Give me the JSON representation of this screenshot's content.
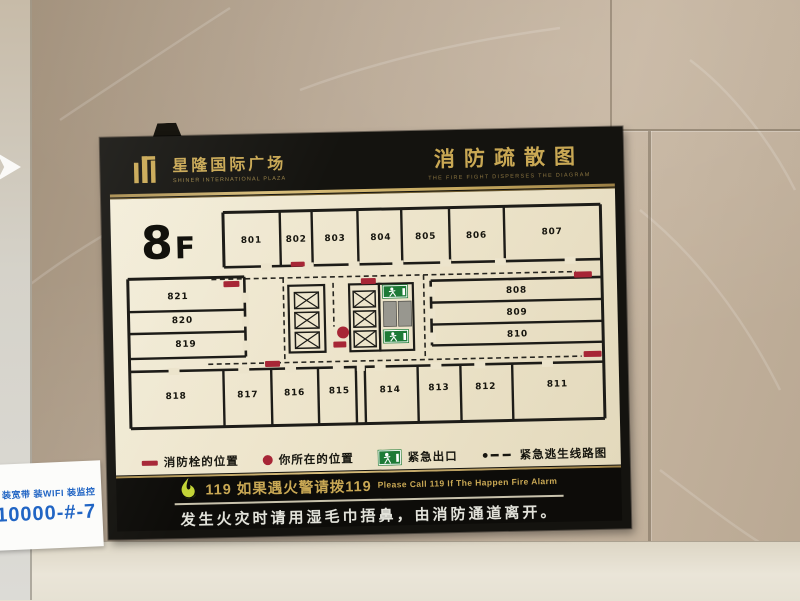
{
  "colors": {
    "gold": "#c9a854",
    "red": "#a72636",
    "green": "#1d7a36",
    "cream": "#ece4cc",
    "blue": "#2165c4",
    "elevator_gray": "#98978f",
    "wall_line": "#1d1c18"
  },
  "sticker": {
    "line1": "装宽带 装WIFI 装监控",
    "line2": "10000-#-7"
  },
  "sign": {
    "header": {
      "brand_cn": "星隆国际广场",
      "brand_en": "SHINER INTERNATIONAL PLAZA",
      "title_cn": "消防疏散图",
      "title_en": "THE FIRE FIGHT DISPERSES THE DIAGRAM"
    },
    "floor_label": {
      "big": "8",
      "small": "F"
    },
    "plan": {
      "view": [
        0,
        0,
        507,
        252
      ],
      "rooms": [
        {
          "id": "801",
          "lx": 141,
          "ly": 46
        },
        {
          "id": "802",
          "lx": 186,
          "ly": 46
        },
        {
          "id": "803",
          "lx": 225,
          "ly": 46
        },
        {
          "id": "804",
          "lx": 271,
          "ly": 46
        },
        {
          "id": "805",
          "lx": 316,
          "ly": 46
        },
        {
          "id": "806",
          "lx": 367,
          "ly": 46
        },
        {
          "id": "807",
          "lx": 443,
          "ly": 44
        },
        {
          "id": "808",
          "lx": 406,
          "ly": 102
        },
        {
          "id": "809",
          "lx": 406,
          "ly": 124
        },
        {
          "id": "810",
          "lx": 406,
          "ly": 146
        },
        {
          "id": "811",
          "lx": 445,
          "ly": 197
        },
        {
          "id": "812",
          "lx": 373,
          "ly": 198
        },
        {
          "id": "813",
          "lx": 326,
          "ly": 198
        },
        {
          "id": "814",
          "lx": 277,
          "ly": 199
        },
        {
          "id": "815",
          "lx": 226,
          "ly": 199
        },
        {
          "id": "816",
          "lx": 181,
          "ly": 200
        },
        {
          "id": "817",
          "lx": 134,
          "ly": 201
        },
        {
          "id": "818",
          "lx": 62,
          "ly": 201
        },
        {
          "id": "819",
          "lx": 73,
          "ly": 149
        },
        {
          "id": "820",
          "lx": 70,
          "ly": 125
        },
        {
          "id": "821",
          "lx": 66,
          "ly": 101
        }
      ],
      "walls": [
        [
          113,
          15,
          492,
          15,
          3
        ],
        [
          492,
          15,
          492,
          230,
          3
        ],
        [
          16,
          230,
          492,
          230,
          3
        ],
        [
          16,
          80,
          16,
          230,
          3
        ],
        [
          16,
          80,
          133,
          80,
          3
        ],
        [
          113,
          15,
          113,
          70,
          3
        ],
        [
          113,
          70,
          492,
          70,
          2.6
        ],
        [
          170,
          15,
          170,
          70,
          2.4
        ],
        [
          202,
          15,
          202,
          70,
          2.4
        ],
        [
          248,
          15,
          248,
          70,
          2.4
        ],
        [
          292,
          15,
          292,
          70,
          2.4
        ],
        [
          340,
          15,
          340,
          70,
          2.4
        ],
        [
          395,
          15,
          395,
          70,
          2.4
        ],
        [
          133,
          80,
          133,
          160,
          2.6
        ],
        [
          16,
          113,
          133,
          113,
          2.4
        ],
        [
          16,
          135,
          133,
          135,
          2.4
        ],
        [
          16,
          160,
          133,
          160,
          2.4
        ],
        [
          320,
          88,
          320,
          153,
          2.6
        ],
        [
          320,
          88,
          492,
          88,
          2.6
        ],
        [
          320,
          110,
          492,
          110,
          2.4
        ],
        [
          320,
          132,
          492,
          132,
          2.4
        ],
        [
          320,
          153,
          492,
          153,
          2.4
        ],
        [
          16,
          173,
          492,
          173,
          2.6
        ],
        [
          110,
          173,
          110,
          230,
          2.4
        ],
        [
          158,
          173,
          158,
          230,
          2.4
        ],
        [
          205,
          173,
          205,
          230,
          2.4
        ],
        [
          243,
          173,
          243,
          230,
          2.4
        ],
        [
          252,
          173,
          252,
          230,
          2.4
        ],
        [
          305,
          173,
          305,
          230,
          2.4
        ],
        [
          348,
          173,
          348,
          230,
          2.4
        ],
        [
          400,
          173,
          400,
          230,
          2.4
        ]
      ],
      "door_gaps": [
        [
          150,
          67,
          11,
          7
        ],
        [
          192,
          67,
          11,
          7
        ],
        [
          238,
          67,
          11,
          7
        ],
        [
          282,
          67,
          11,
          7
        ],
        [
          330,
          67,
          11,
          7
        ],
        [
          385,
          67,
          11,
          7
        ],
        [
          455,
          67,
          11,
          7
        ],
        [
          55,
          170,
          11,
          7
        ],
        [
          125,
          170,
          11,
          7
        ],
        [
          172,
          170,
          11,
          7
        ],
        [
          220,
          170,
          11,
          7
        ],
        [
          262,
          170,
          11,
          7
        ],
        [
          318,
          170,
          11,
          7
        ],
        [
          362,
          170,
          11,
          7
        ],
        [
          430,
          170,
          11,
          7
        ],
        [
          244,
          170,
          8,
          7
        ],
        [
          130,
          96,
          7,
          10
        ],
        [
          130,
          120,
          7,
          10
        ],
        [
          130,
          144,
          7,
          10
        ],
        [
          317,
          94,
          7,
          10
        ],
        [
          317,
          116,
          7,
          10
        ],
        [
          317,
          140,
          7,
          10
        ]
      ],
      "shafts": [
        {
          "x": 177,
          "y": 90,
          "w": 36,
          "h": 67,
          "cells": [
            [
              183,
              97,
              24,
              16
            ],
            [
              183,
              117,
              24,
              16
            ],
            [
              183,
              137,
              24,
              16
            ]
          ]
        },
        {
          "x": 238,
          "y": 90,
          "w": 30,
          "h": 67,
          "cells": [
            [
              242,
              97,
              22,
              16
            ],
            [
              242,
              117,
              22,
              16
            ],
            [
              242,
              137,
              22,
              16
            ]
          ]
        }
      ],
      "elevator_bay": {
        "x": 268,
        "y": 90,
        "w": 34,
        "h": 67,
        "cars": [
          [
            272,
            108,
            13,
            25
          ],
          [
            287,
            108,
            13,
            25
          ]
        ]
      },
      "exits": [
        [
          271,
          91,
          26,
          14
        ],
        [
          271,
          136,
          26,
          14
        ]
      ],
      "hydrants": [
        [
          112,
          84,
          16,
          6
        ],
        [
          250,
          84,
          15,
          6
        ],
        [
          180,
          66,
          14,
          5
        ],
        [
          464,
          82,
          18,
          6
        ],
        [
          152,
          165,
          15,
          6
        ],
        [
          472,
          162,
          18,
          6
        ],
        [
          221,
          147,
          13,
          6
        ]
      ],
      "you_are_here": {
        "cx": 231,
        "cy": 138,
        "r": 6
      },
      "routes": [
        [
          100,
          82,
          466,
          82
        ],
        [
          95,
          167,
          470,
          167
        ],
        [
          172,
          82,
          172,
          167
        ],
        [
          313,
          82,
          313,
          167
        ],
        [
          222,
          88,
          222,
          132
        ]
      ]
    },
    "legend": [
      {
        "icon": "hydrant",
        "label": "消防栓的位置"
      },
      {
        "icon": "dot",
        "label": "你所在的位置"
      },
      {
        "icon": "exit",
        "label": "紧急出口"
      },
      {
        "icon": "route",
        "label": "紧急逃生线路图"
      }
    ],
    "footer": {
      "line1_zh": "119 如果遇火警请拨119",
      "line1_en": "Please Call 119 If The Happen Fire Alarm",
      "line2": "发生火灾时请用湿毛巾捂鼻，由消防通道离开。"
    }
  }
}
